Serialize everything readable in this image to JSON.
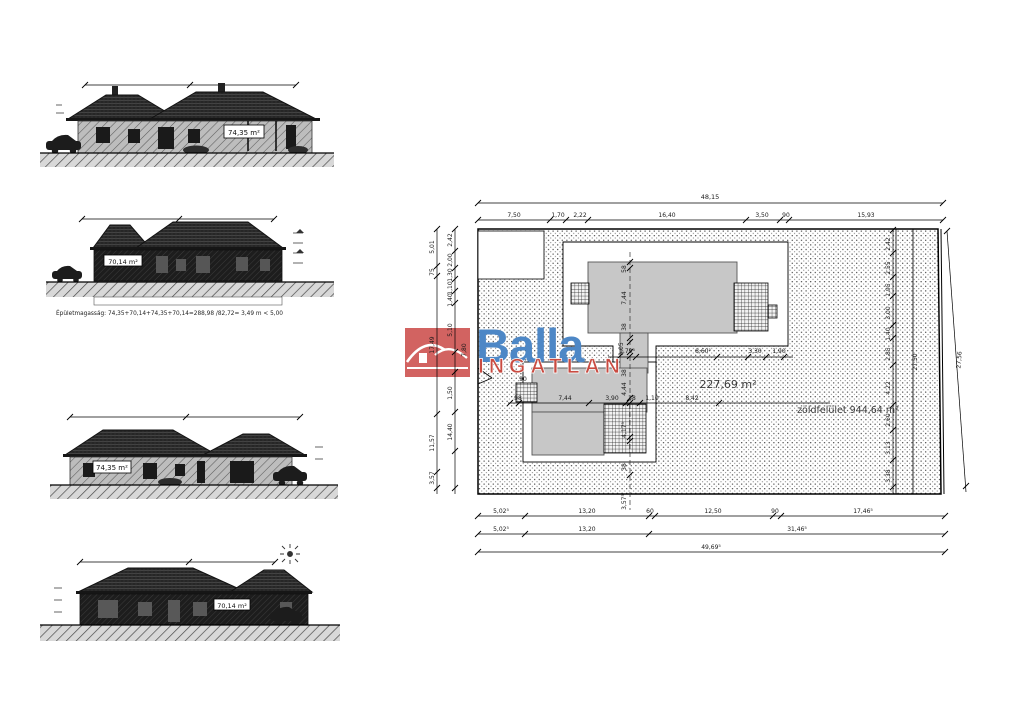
{
  "logo": {
    "brand": "Balla",
    "subtitle": "INGATLAN",
    "colors": {
      "brand_blue": "#4d87c6",
      "brand_red": "#c94b41",
      "box_red": "#d26361"
    }
  },
  "elevations": {
    "e1_area": "74,35 m²",
    "e2_area": "70,14 m²",
    "e3_area": "74,35 m²",
    "e4_area": "70,14 m²",
    "height_note": "Épületmagasság: 74,35+70,14+74,35+70,14=288,98 /82,72= 3,49 m < 5,00"
  },
  "siteplan": {
    "building_area": "227,69 m²",
    "green_area": "zöldfelület 944,64 m²",
    "top_total": "48,15",
    "top": [
      "7,50",
      "1,70",
      "2,22",
      "16,40",
      "3,50",
      "90",
      "15,93"
    ],
    "bottom1": [
      "5,02⁵",
      "13,20",
      "60",
      "12,50",
      "90",
      "17,46⁵"
    ],
    "bottom2": [
      "5,02⁵",
      "13,20",
      "31,46⁵"
    ],
    "bottom_total": "49,69⁵",
    "left_outer": [
      "5,01",
      "75",
      "17,49",
      "11,57",
      "3,57"
    ],
    "left_inner": [
      "2,42",
      "2,00",
      "1,30",
      "1,10",
      "1,40",
      "5,10",
      "7,80",
      "1,50",
      "14,40"
    ],
    "right_chain": [
      "2,42",
      "2,55",
      "1,95",
      "3,00",
      "1,40",
      "2,85",
      "4,22",
      "2,60",
      "3,13",
      "3,38"
    ],
    "right_inner_total": "27,50",
    "right_outer_total": "27,56",
    "axis_chain": [
      "58",
      "7,44",
      "38",
      "1,05",
      "38",
      "4,44",
      "4,17⁵",
      "38",
      "3,57⁵"
    ],
    "mid_row": [
      "1,79⁵",
      "8,60⁵",
      "3,30",
      "1,90"
    ],
    "lower_row": [
      "98",
      "7,44",
      "3,90",
      "38",
      "1,10",
      "8,42"
    ],
    "misc_90": "90"
  }
}
